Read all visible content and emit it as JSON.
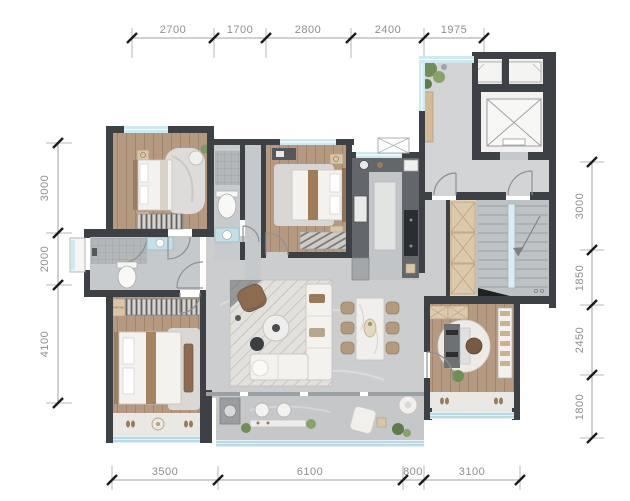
{
  "type": "apartment-floor-plan",
  "dimensions_mm": {
    "top": [
      "2700",
      "1700",
      "2800",
      "2400",
      "1975"
    ],
    "left": [
      "3000",
      "2000",
      "4100"
    ],
    "right": [
      "3000",
      "1850",
      "2450",
      "1800"
    ],
    "bottom": [
      "3500",
      "6100",
      "800",
      "3100"
    ]
  },
  "palette": {
    "wall": "#3d4145",
    "wood_floor": "#b59a81",
    "bath_tile": "#c8cbcd",
    "living_floor": "#cbcdcf",
    "balcony_floor": "#c5c7c9",
    "window_glass": "#cfe9f2",
    "wardrobe_tan": "#dcc9ab",
    "plant_green": "#6f8f56",
    "sofa_white": "#f3f2ef",
    "accent_brown": "#8d6b4f",
    "dim_text": "#8c8f92"
  }
}
